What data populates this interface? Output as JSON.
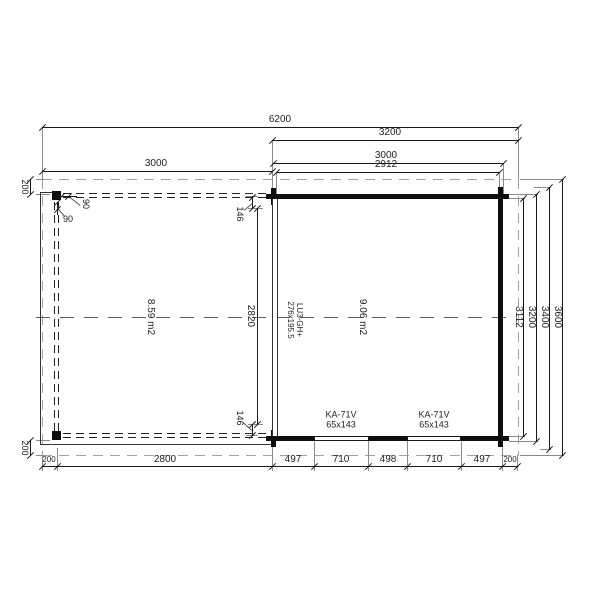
{
  "drawing": {
    "dims_top": {
      "total": "6200",
      "right_outer": "3200",
      "left_section": "3000",
      "right_building": "3000",
      "right_interior": "2912"
    },
    "dims_bottom": [
      "200",
      "2800",
      "497",
      "710",
      "498",
      "710",
      "497",
      "200"
    ],
    "dims_right": {
      "interior": "3112",
      "building": "3200",
      "with_overhang": "3400",
      "total": "3600"
    },
    "dims_left": {
      "overhang_top": "200",
      "overhang_bottom": "200",
      "offset_top": "146",
      "offset_bottom": "146",
      "interior": "2820"
    },
    "post": {
      "width": "90",
      "depth": "90"
    },
    "rooms": {
      "left_area": "8.59 m2",
      "right_area": "9.06 m2"
    },
    "door": {
      "code": "LU3-GH+",
      "size": "276x195.5"
    },
    "window": {
      "code": "KA-71V",
      "size": "65x143"
    }
  }
}
